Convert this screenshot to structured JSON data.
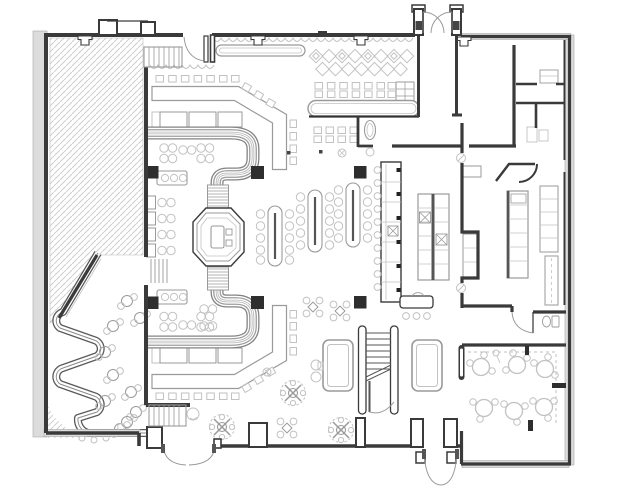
{
  "meta": {
    "title": "Restaurant and bar floor plan drawing",
    "drawing_type": "architectural plan, black/gray line work on white",
    "text_labels_visible": "none"
  },
  "canvas": {
    "width": 620,
    "height": 497
  },
  "colors": {
    "paper": "#ffffff",
    "wall": "#3a3a3a",
    "poche": "#dcdcdc",
    "furn": "#9a9a9a",
    "furnlight": "#c2c2c2",
    "hatch": "#cfcfcf",
    "column": "#2e2e2e",
    "band": "#828282",
    "bench": "#5a5a5a"
  },
  "areas": [
    {
      "id": "terrace-hatched",
      "label": "Hatched area upper/left (adjacent space)"
    },
    {
      "id": "serpentine-lounge",
      "label": "Lounge with serpentine winding bench, lower left"
    },
    {
      "id": "upper-banquette-bar",
      "label": "Upper C-shaped banquette with bar and stools"
    },
    {
      "id": "lower-banquette-bar",
      "label": "Lower C-shaped banquette with bar and stools (mirror)"
    },
    {
      "id": "center-booth-pod",
      "label": "Octagonal center booth pod with table"
    },
    {
      "id": "top-bar",
      "label": "Long bar counter with stool rows, top center"
    },
    {
      "id": "lattice-screen",
      "label": "Diamond lattice floor/screen band, top"
    },
    {
      "id": "communal-tables",
      "label": "Three pill-shaped communal tables with chairs"
    },
    {
      "id": "service-bar",
      "label": "Service bar / station strip"
    },
    {
      "id": "kitchen",
      "label": "Kitchen with equipment counters and island"
    },
    {
      "id": "back-rooms",
      "label": "Back-of-house rooms, top right"
    },
    {
      "id": "restroom",
      "label": "Small WC off corridor"
    },
    {
      "id": "private-dining",
      "label": "Private dining room with six round tables"
    },
    {
      "id": "stairwell",
      "label": "Staircase with break line and door"
    },
    {
      "id": "billiards",
      "label": "Two game/billiard tables flanking the stair"
    },
    {
      "id": "north-entry",
      "label": "North double-door entry vestibule"
    },
    {
      "id": "south-entry",
      "label": "South double-door entry"
    },
    {
      "id": "west-entry",
      "label": "West single door with steps"
    },
    {
      "id": "southwest-entry",
      "label": "Southwest double door with steps"
    }
  ],
  "inventory": {
    "communal_tables": 3,
    "billiard_tables": 2,
    "private_dining_tables": 6,
    "structural_columns": 6,
    "entry_doors": 4,
    "medallion_floor_symbols": 3,
    "banquette_units": 2
  }
}
